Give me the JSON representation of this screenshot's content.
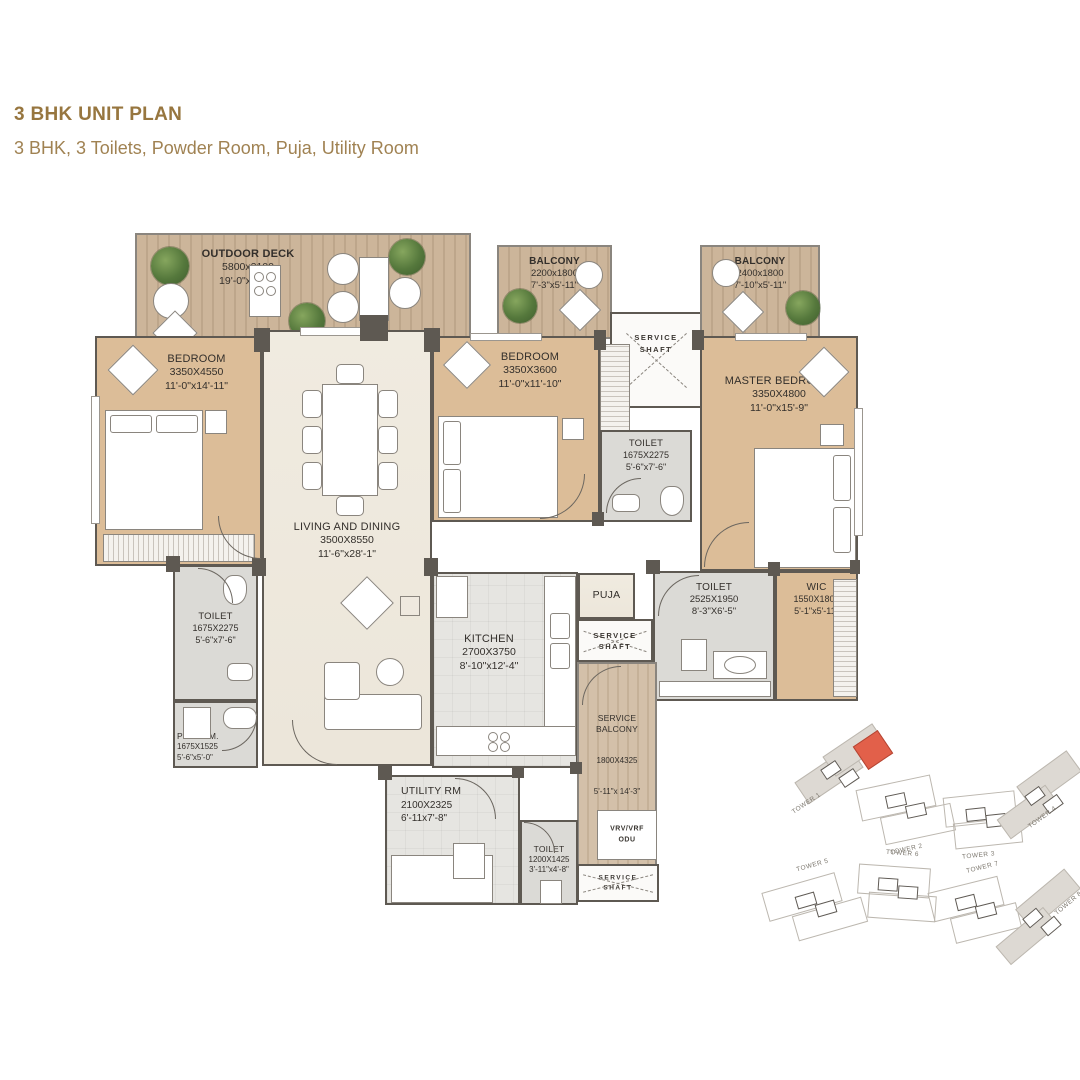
{
  "header": {
    "title": "3 BHK UNIT PLAN",
    "subtitle": "3 BHK, 3 Toilets, Powder Room, Puja, Utility Room"
  },
  "colors": {
    "title_brown": "#97763f",
    "wall_dark": "#5e5952",
    "bedroom_tan": "#dcbd98",
    "deck_wood": "#ccb59a",
    "highlight_red": "#e2604a"
  },
  "rooms": {
    "outdoor_deck": {
      "name": "OUTDOOR DECK",
      "dim_mm": "5800x2100",
      "dim_ft": "19'-0\"x6'-11\""
    },
    "balcony1": {
      "name": "BALCONY",
      "dim_mm": "2200x1800",
      "dim_ft": "7'-3\"x5'-11\""
    },
    "balcony2": {
      "name": "BALCONY",
      "dim_mm": "2400x1800",
      "dim_ft": "7'-10\"x5'-11\""
    },
    "bedroom1": {
      "name": "BEDROOM",
      "dim_mm": "3350X4550",
      "dim_ft": "11'-0\"x14'-11\""
    },
    "bedroom2": {
      "name": "BEDROOM",
      "dim_mm": "3350X3600",
      "dim_ft": "11'-0\"x11'-10\""
    },
    "master_bedroom": {
      "name": "MASTER BEDROOM",
      "dim_mm": "3350X4800",
      "dim_ft": "11'-0\"x15'-9\""
    },
    "living_dining": {
      "name": "LIVING AND DINING",
      "dim_mm": "3500X8550",
      "dim_ft": "11'-6\"x28'-1\""
    },
    "toilet_mid": {
      "name": "TOILET",
      "dim_mm": "1675X2275",
      "dim_ft": "5'-6\"x7'-6\""
    },
    "toilet_left": {
      "name": "TOILET",
      "dim_mm": "1675X2275",
      "dim_ft": "5'-6\"x7'-6\""
    },
    "pwd_room": {
      "name": "PWD. RM.",
      "dim_mm": "1675X1525",
      "dim_ft": "5'-6\"x5'-0\""
    },
    "kitchen": {
      "name": "KITCHEN",
      "dim_mm": "2700X3750",
      "dim_ft": "8'-10\"x12'-4\""
    },
    "puja": {
      "name": "PUJA"
    },
    "toilet_right": {
      "name": "TOILET",
      "dim_mm": "2525X1950",
      "dim_ft": "8'-3\"X6'-5\""
    },
    "wic": {
      "name": "WIC",
      "dim_mm": "1550X1800",
      "dim_ft": "5'-1\"x5'-11\""
    },
    "service_balcony": {
      "name": "SERVICE\nBALCONY",
      "dim_mm": "1800X4325",
      "dim_ft": "5'-11\"x 14'-3\""
    },
    "utility": {
      "name": "UTILITY RM",
      "dim_mm": "2100X2325",
      "dim_ft": "6'-11x7'-8\""
    },
    "toilet_bottom": {
      "name": "TOILET",
      "dim_mm": "1200X1425",
      "dim_ft": "3'-11\"x4'-8\""
    }
  },
  "labels": {
    "service_shaft": "SERVICE\nSHAFT",
    "vrv": "VRV/VRF\nODU"
  },
  "keyplan": {
    "towers": [
      "TOWER 1",
      "TOWER 2",
      "TOWER 3",
      "TOWER 4",
      "TOWER 5",
      "TOWER 6",
      "TOWER 7",
      "TOWER 8"
    ]
  }
}
